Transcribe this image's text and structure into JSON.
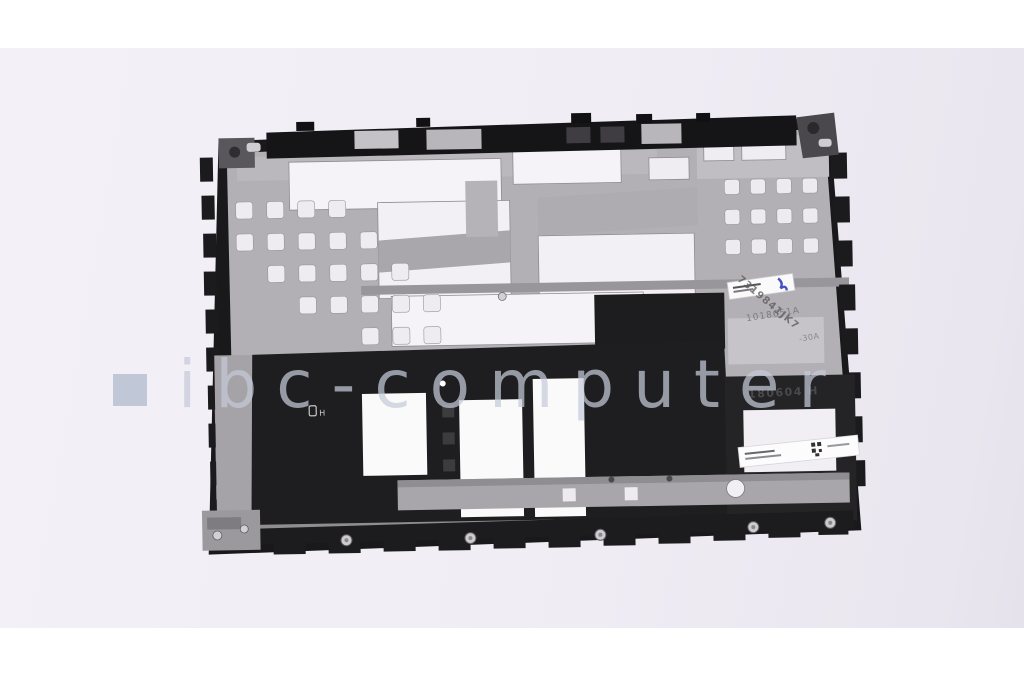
{
  "photo": {
    "alt": "Top-down product photo of a laptop internal magnesium structure frame with black plastic trim",
    "background": "#f1edf5",
    "watermark": {
      "text": "ibc-computer",
      "color": "#c5cad8",
      "square_color": "#bcc3d3"
    },
    "markings": {
      "date_stamp": "180604 H",
      "engraved_code": "1018651A",
      "diagonal_code": "7319841JK7",
      "partial_code": "-30A"
    },
    "part_colors": {
      "metal": "#b2b0b4",
      "plastic": "#1c1c1e",
      "cutout": "#f6f3f8"
    }
  }
}
